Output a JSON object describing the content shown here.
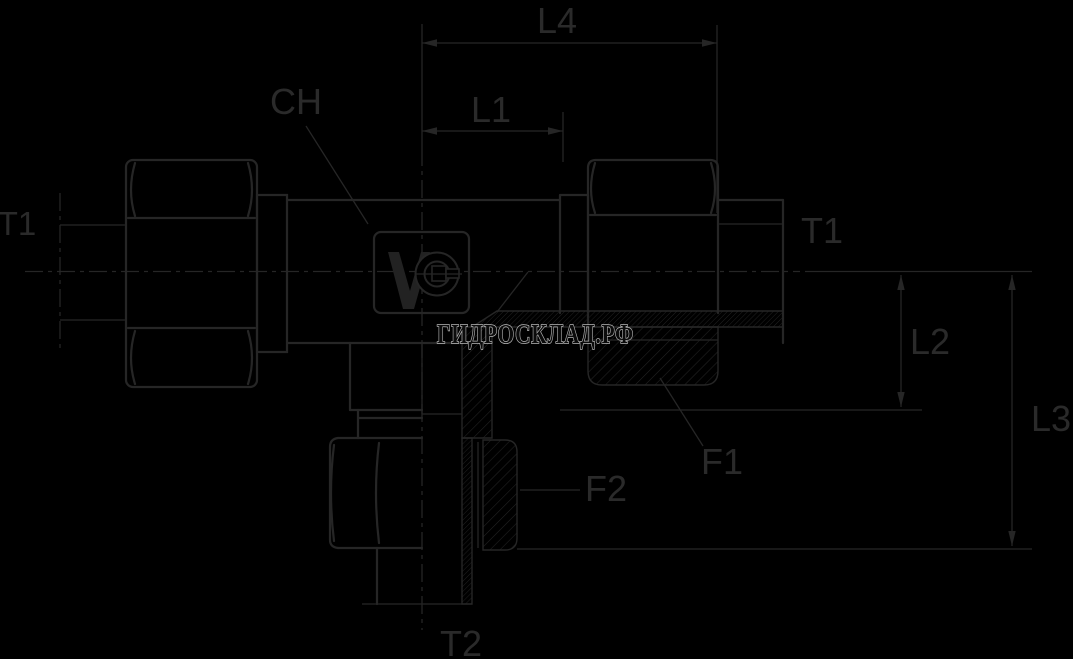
{
  "page": {
    "background": "#000000"
  },
  "drawing": {
    "kind": "engineering-drawing-tee-fitting-half-section",
    "line_color": "#262626",
    "watermark": {
      "text": "ГИДРОСКЛАД.РФ"
    },
    "labels": {
      "l4": "L4",
      "l1": "L1",
      "ch": "CH",
      "t1_left": "T1",
      "t1_right": "T1",
      "l2": "L2",
      "l3": "L3",
      "f1": "F1",
      "f2": "F2",
      "t2": "T2"
    },
    "logo": {
      "name": "vo-manufacturer-logo"
    }
  }
}
